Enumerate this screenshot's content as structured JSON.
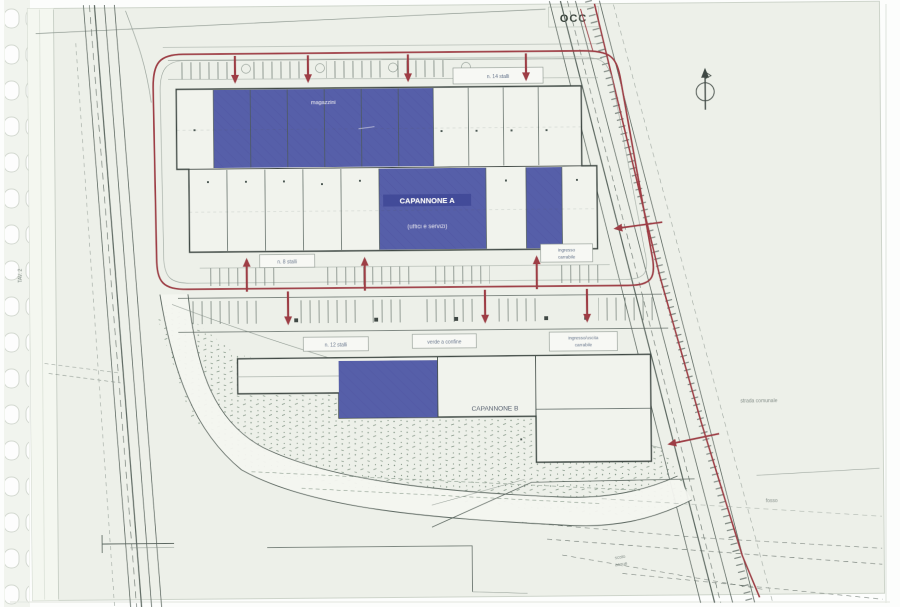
{
  "document": {
    "kind": "scanned site plan sheet in punched plastic sleeve",
    "stamp": "OCC",
    "sheet_tag_vertical": "TAV. 2"
  },
  "colors": {
    "highlight_blue": "#565ea9",
    "route_red": "#9e3c44",
    "ink": "#4d5a54",
    "sheet": "#edf0e9"
  },
  "buildings": {
    "a": {
      "name": "CAPANNONE A",
      "subtitle": "(uffici e servizi)",
      "roof_label": "magazzini"
    },
    "b": {
      "name": "CAPANNONE B"
    }
  },
  "labels": {
    "stalli_top": "n. 14 stalli",
    "stalli_front": "n. 8 stalli",
    "gate_up_1": "ingresso",
    "gate_up_2": "carrabile",
    "stalli_low": "n. 12 stalli",
    "verde": "verde a confine",
    "gate_low_1": "ingresso/uscita",
    "gate_low_2": "carrabile",
    "road_right": "strada comunale",
    "fosso": "fosso",
    "scolo_1": "scolo",
    "scolo_2": "acque"
  }
}
